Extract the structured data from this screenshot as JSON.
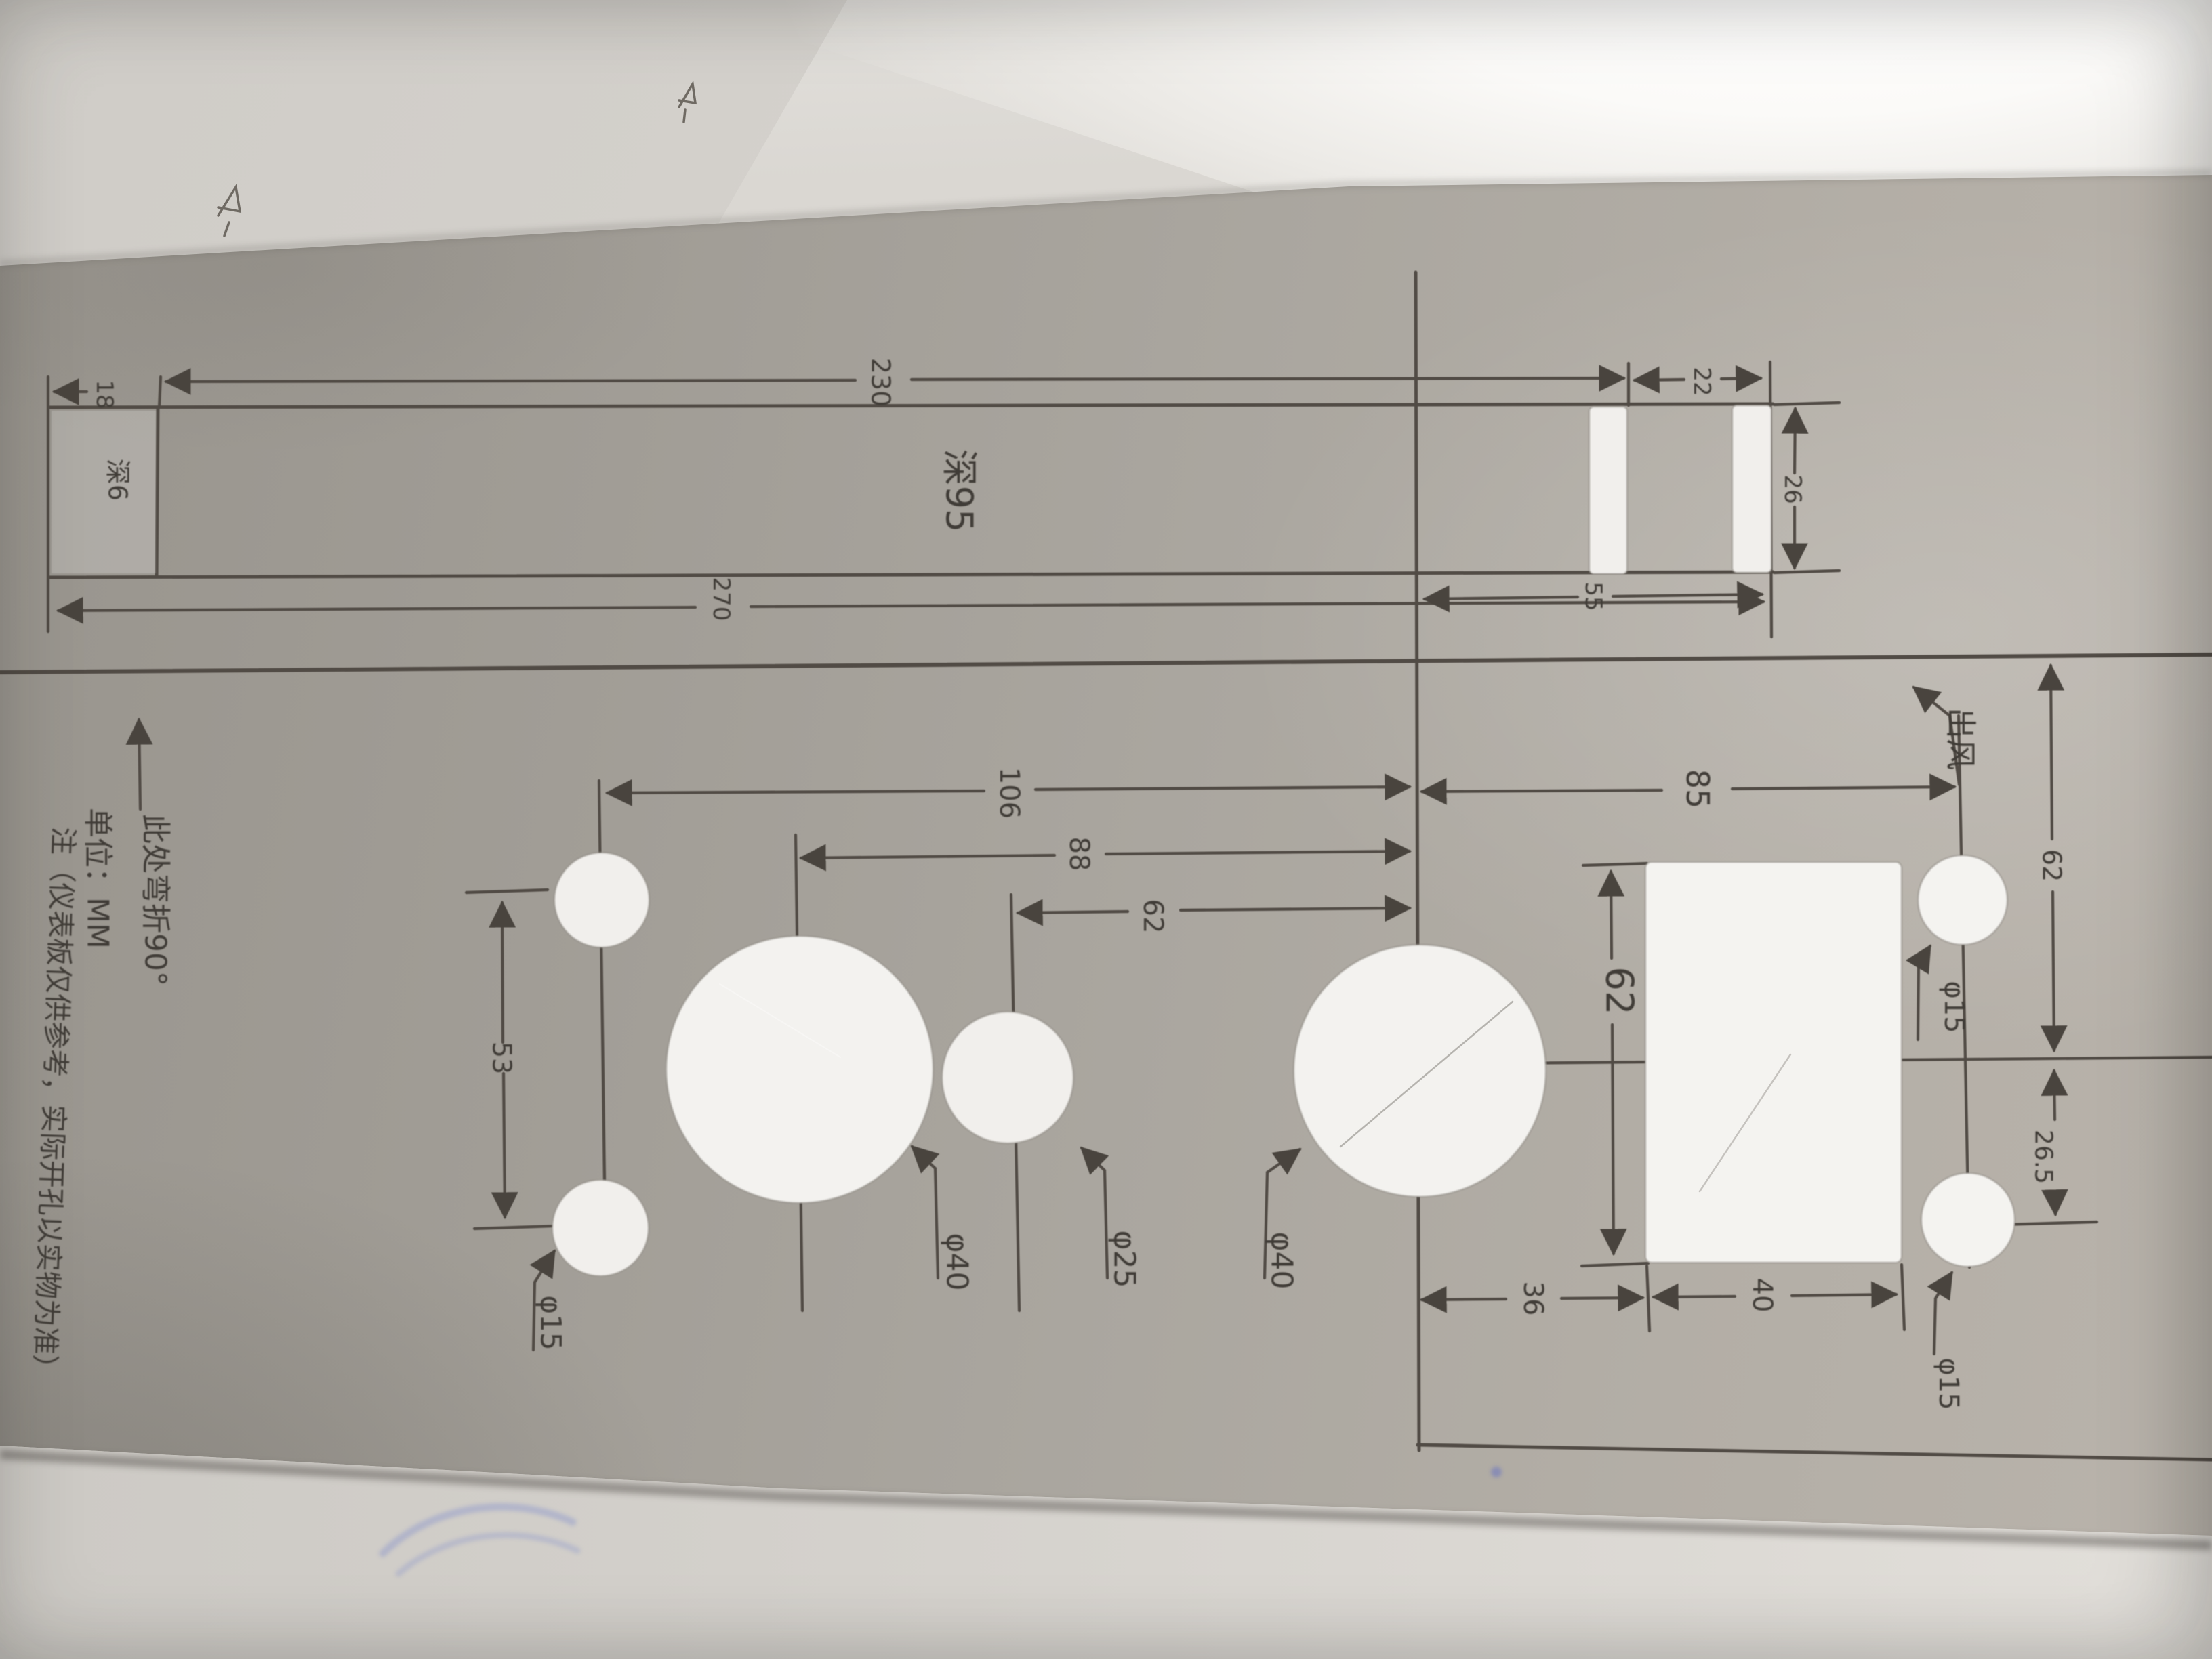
{
  "notes": {
    "fold": "此处弯折90°",
    "unit": "单位：MM",
    "disclaimer": "注（仪表板仅供参考，实际开孔以实物为准）"
  },
  "top_bar": {
    "slot_length": "230",
    "slot_depth": "深95",
    "total_length": "270",
    "tab_width": "18",
    "tab_depth": "深6",
    "gap": "22",
    "bar_width": "26",
    "end_offset": "55"
  },
  "hole_dims": {
    "col_offset": "106",
    "big_left_offset": "88",
    "mid_offset": "62",
    "small_spacing": "53",
    "small_dia_left": "φ15",
    "big_dia_left": "φ40",
    "mid_dia": "φ25",
    "big_dia_right": "φ40"
  },
  "right_section": {
    "offset": "85",
    "vent": "出风",
    "top_height": "62",
    "small_drop": "26.5",
    "rect_height": "62",
    "rect_offset": "36",
    "rect_width": "40",
    "small_dia_top": "φ15",
    "small_dia_bottom": "φ15"
  },
  "colors": {
    "board_gray": "#a8a49d",
    "ink": "#4a453f",
    "hole_white": "#f1efec",
    "pen_blue": "#7c8cc4"
  }
}
